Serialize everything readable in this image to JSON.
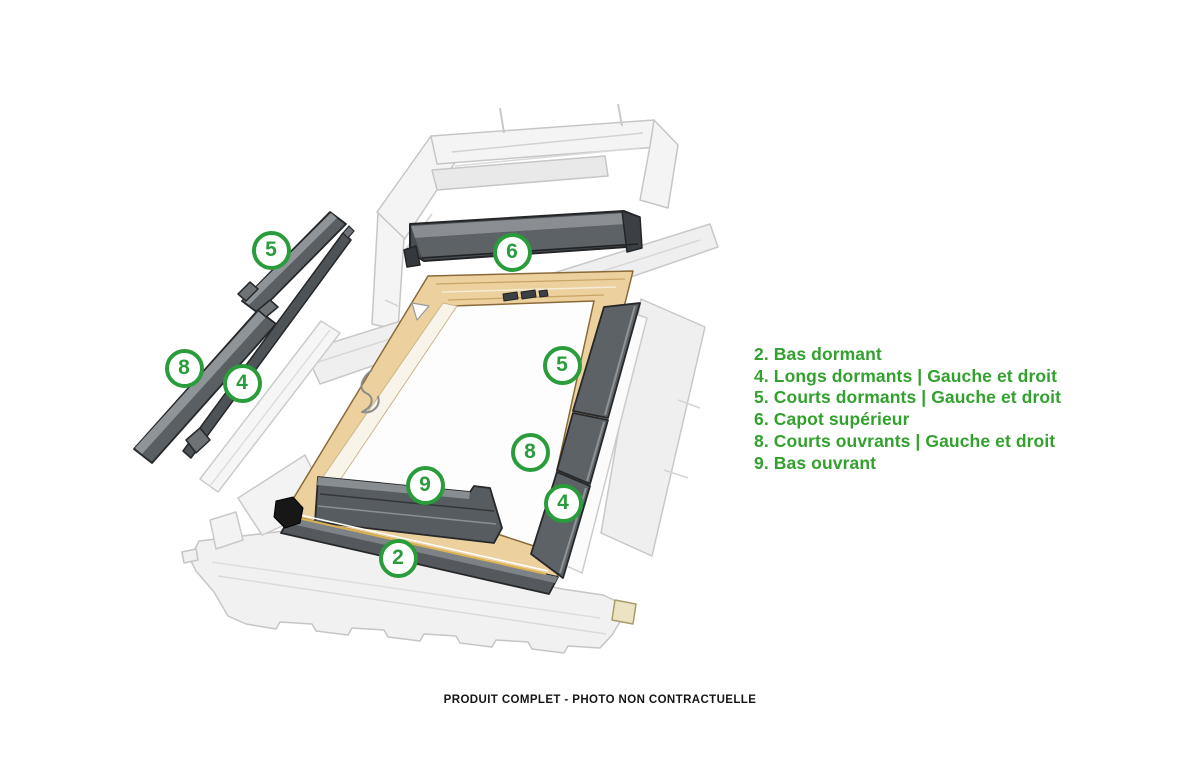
{
  "legend": {
    "items": [
      {
        "number": "2.",
        "label": "Bas dormant"
      },
      {
        "number": "4.",
        "label": "Longs dormants | Gauche et droit"
      },
      {
        "number": "5.",
        "label": "Courts dormants | Gauche et droit"
      },
      {
        "number": "6.",
        "label": "Capot supérieur"
      },
      {
        "number": "8.",
        "label": "Courts ouvrants | Gauche et droit"
      },
      {
        "number": "9.",
        "label": "Bas ouvrant"
      }
    ]
  },
  "caption": "PRODUIT COMPLET - PHOTO NON CONTRACTUELLE",
  "diagram": {
    "description": "Exploded view of roof window flashing kit",
    "badges": [
      {
        "id": "badge-5-left",
        "number": "5"
      },
      {
        "id": "badge-8-left",
        "number": "8"
      },
      {
        "id": "badge-4-left",
        "number": "4"
      },
      {
        "id": "badge-6-top",
        "number": "6"
      },
      {
        "id": "badge-5-right",
        "number": "5"
      },
      {
        "id": "badge-8-right",
        "number": "8"
      },
      {
        "id": "badge-4-right",
        "number": "4"
      },
      {
        "id": "badge-9-bottom",
        "number": "9"
      },
      {
        "id": "badge-2-bottom",
        "number": "2"
      }
    ]
  },
  "colors": {
    "legend_green": "#32a12e",
    "badge_ring_green": "#2a9c3b",
    "metal_dark": "#55595d",
    "metal_light": "#8e9398",
    "wood": "#ecd09e",
    "ghost_gray": "#efefef",
    "caption_black": "#151515"
  }
}
